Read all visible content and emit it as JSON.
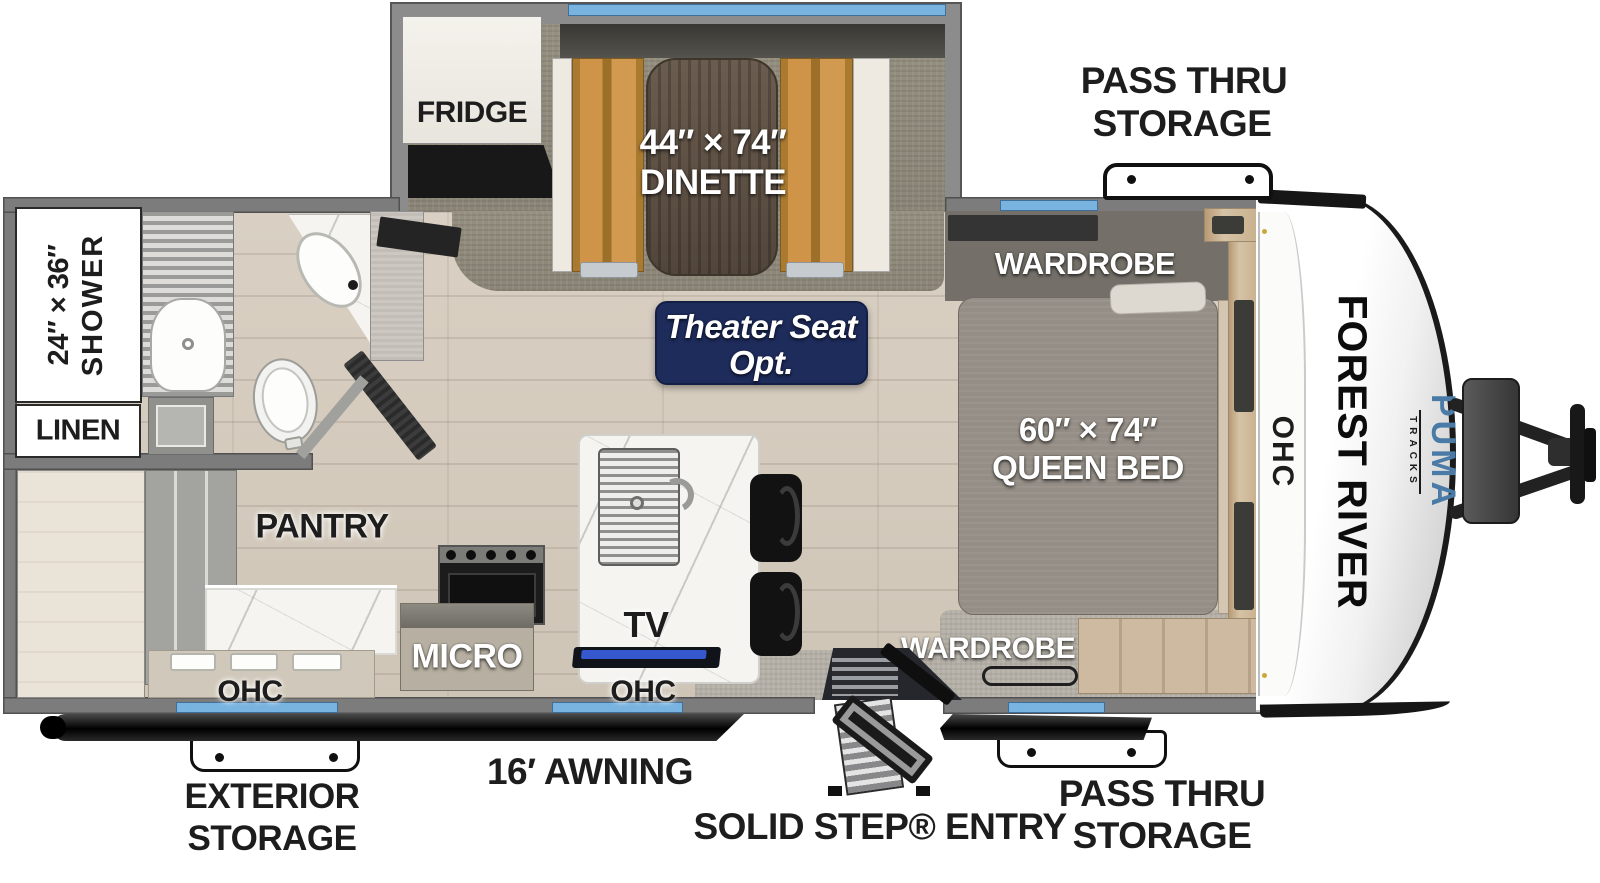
{
  "title": "Forest River Puma Tracks travel trailer floor plan",
  "brand": {
    "manufacturer": "FOREST RIVER",
    "model": "PUMA",
    "submodel": "TRACKS"
  },
  "labels": {
    "pass_thru_top_line1": "PASS THRU",
    "pass_thru_top_line2": "STORAGE",
    "fridge": "FRIDGE",
    "dinette_size": "44″ × 74″",
    "dinette": "DINETTE",
    "wardrobe_top": "WARDROBE",
    "theater_line1": "Theater Seat",
    "theater_line2": "Opt.",
    "shower_size": "24″ × 36″",
    "shower": "SHOWER",
    "linen": "LINEN",
    "pantry": "PANTRY",
    "queen_size": "60″ × 74″",
    "queen": "QUEEN BED",
    "ohc_left": "OHC",
    "ohc_mid": "OHC",
    "ohc_front": "OHC",
    "micro": "MICRO",
    "tv": "TV",
    "wardrobe_bottom": "WARDROBE",
    "exterior_storage_line1": "EXTERIOR",
    "exterior_storage_line2": "STORAGE",
    "awning": "16′ AWNING",
    "solid_step": "SOLID STEP® ENTRY",
    "pass_thru_bottom_line1": "PASS THRU",
    "pass_thru_bottom_line2": "STORAGE"
  },
  "colors": {
    "window_blue": "#79b3e0",
    "badge_navy": "#1e2c5c",
    "puma_blue": "#4a7ba6",
    "bench_tan": "#c89048",
    "wall_gray": "#7c7c7c",
    "mattress_gray": "#958e86"
  }
}
